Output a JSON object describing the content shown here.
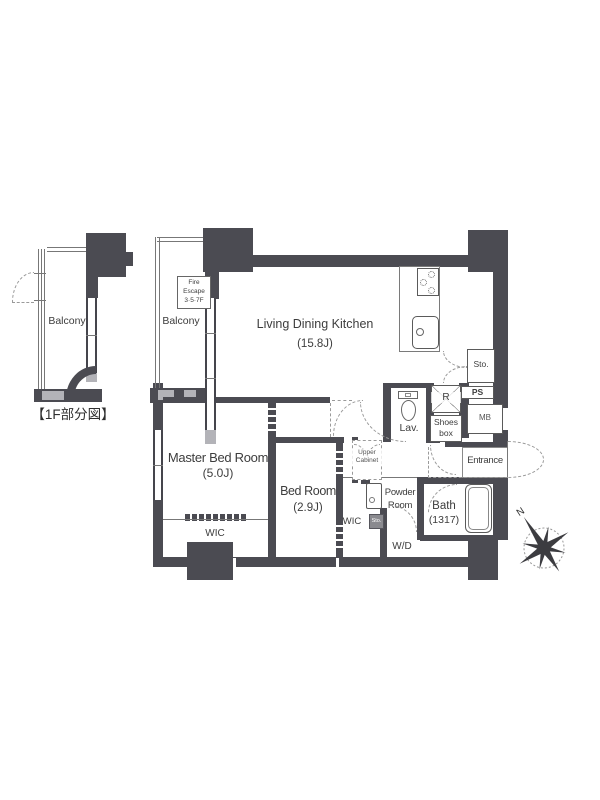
{
  "colors": {
    "wall": "#4b4b52",
    "light_gray": "#b3b3b8",
    "line": "#777777",
    "dashed": "#9a9a9a",
    "text": "#3d3d3d"
  },
  "partial_plan": {
    "balcony": "Balcony",
    "caption": "【1F部分図】"
  },
  "main_plan": {
    "balcony": "Balcony",
    "fire_escape": {
      "l1": "Fire",
      "l2": "Escape",
      "l3": "3·5·7F"
    },
    "ldk": {
      "name": "Living Dining Kitchen",
      "size": "(15.8J)"
    },
    "master_bedroom": {
      "name": "Master Bed Room",
      "size": "(5.0J)"
    },
    "master_wic": "WIC",
    "bedroom": {
      "name": "Bed Room",
      "size": "(2.9J)"
    },
    "bedroom_wic": "WIC",
    "upper_cabinet": {
      "l1": "Upper",
      "l2": "Cabinet"
    },
    "powder_room": {
      "l1": "Powder",
      "l2": "Room"
    },
    "washer_dryer": "W/D",
    "bath": {
      "name": "Bath",
      "size": "(1317)"
    },
    "lavatory": "Lav.",
    "refrigerator": "R",
    "shoes_box": {
      "l1": "Shoes",
      "l2": "box"
    },
    "storage": "Sto.",
    "storage_small": "Sto.",
    "pipe_space": "PS",
    "meter_box": "MB",
    "entrance": "Entrance"
  },
  "compass": {
    "north": "N"
  }
}
